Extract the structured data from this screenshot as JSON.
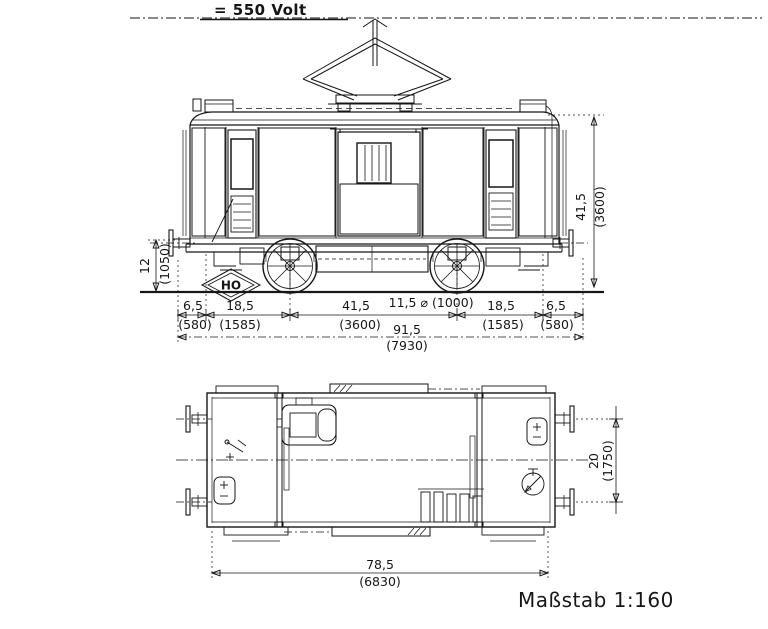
{
  "drawing": {
    "voltage_label": "= 550 Volt",
    "logo_text": "HO",
    "scale_label": "Maßstab 1:160"
  },
  "side_view": {
    "dims": {
      "buffer_height": {
        "model": "12",
        "proto": "(1050)"
      },
      "body_height": {
        "model": "41,5",
        "proto": "(3600)"
      },
      "overhang_left": {
        "model": "6,5",
        "proto": "(580)"
      },
      "end_to_axle_left": {
        "model": "18,5",
        "proto": "(1585)"
      },
      "wheelbase": {
        "model": "41,5",
        "proto": "(3600)"
      },
      "wheel_diameter": {
        "model": "11,5 ⌀",
        "proto": "(1000)"
      },
      "length_over_buffers": {
        "model": "91,5",
        "proto": "(7930)"
      },
      "end_to_axle_right": {
        "model": "18,5",
        "proto": "(1585)"
      },
      "overhang_right": {
        "model": "6,5",
        "proto": "(580)"
      }
    }
  },
  "plan_view": {
    "dims": {
      "width_over_buffers": {
        "model": "20",
        "proto": "(1750)"
      },
      "body_length": {
        "model": "78,5",
        "proto": "(6830)"
      }
    }
  }
}
